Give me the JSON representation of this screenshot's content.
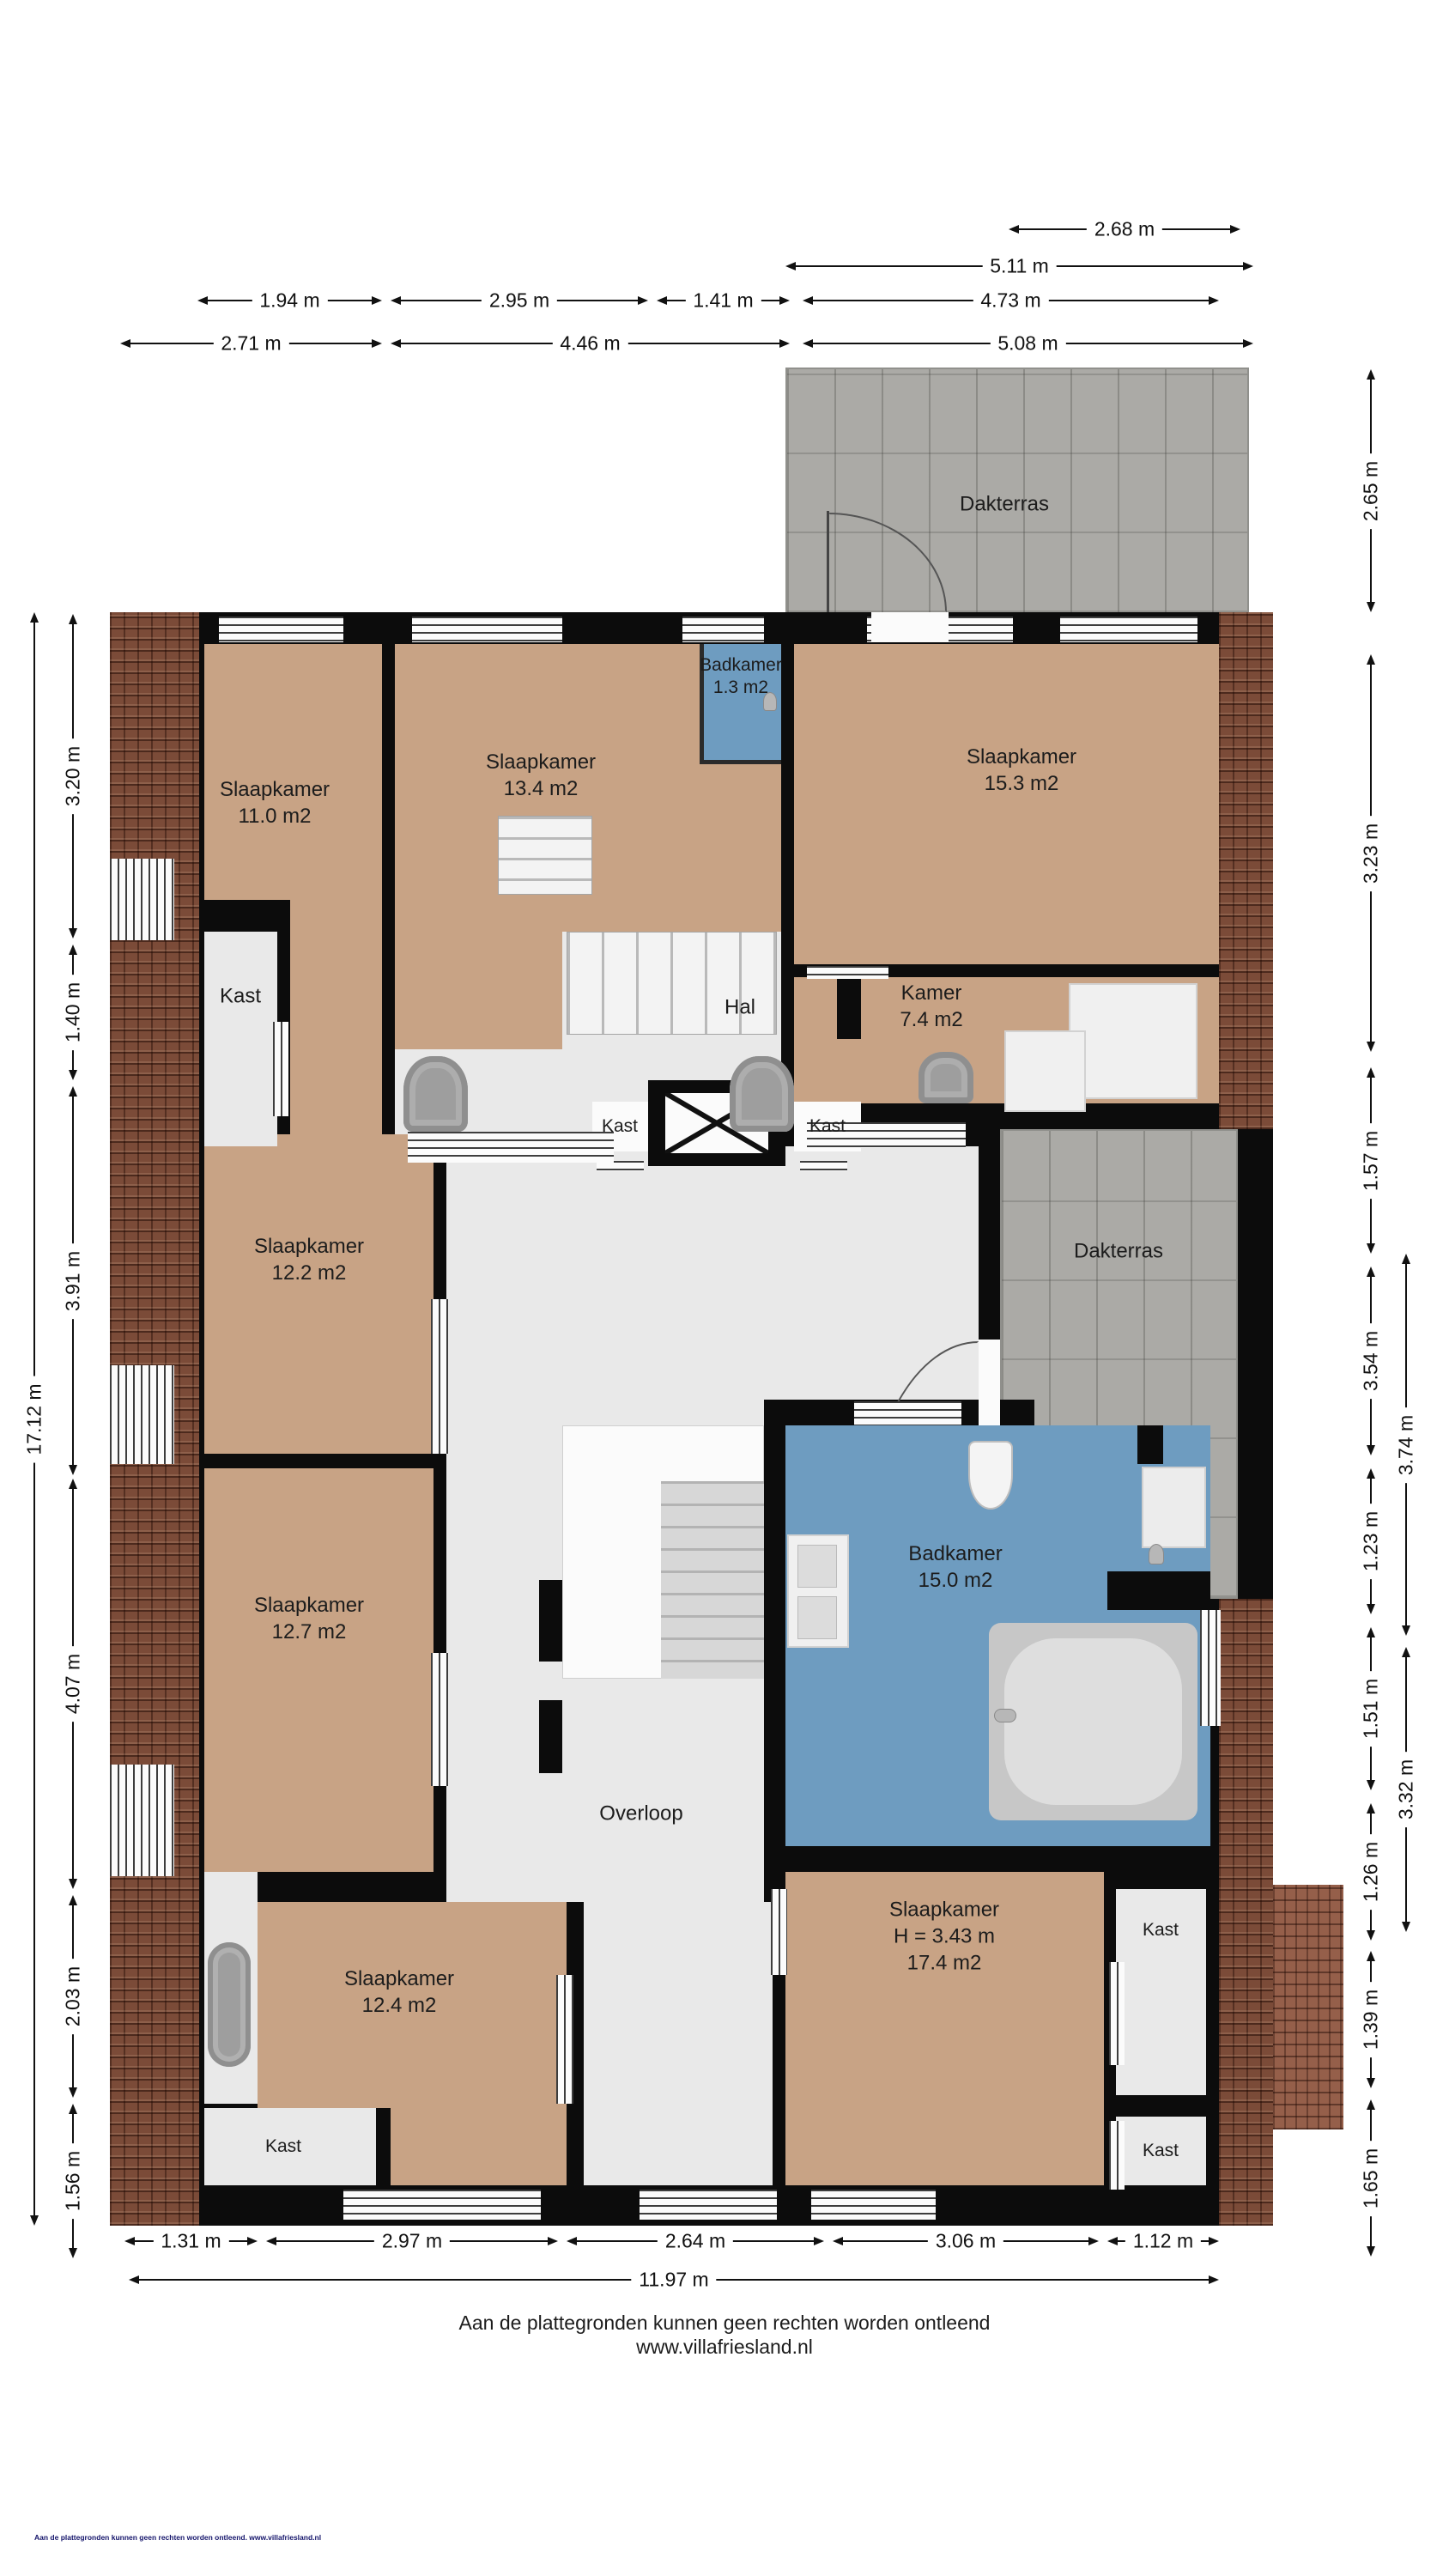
{
  "title": "Plattegrond verdieping",
  "colors": {
    "wall": "#0c0c0c",
    "bedroom_floor": "#c8a385",
    "hall_floor": "#e9e9e9",
    "bathroom_floor": "#6e9cc0",
    "terrace_tiles": "#abaaa6",
    "brick_edge": "#7b4b38",
    "dimension_line": "#111111"
  },
  "rooms": {
    "dakterras_boven": "Dakterras",
    "dakterras_midden": "Dakterras",
    "slaapkamer_linksboven": {
      "name": "Slaapkamer",
      "area": "11.0 m2"
    },
    "slaapkamer_middenboven": {
      "name": "Slaapkamer",
      "area": "13.4 m2"
    },
    "badkamer_klein": {
      "name": "Badkamer",
      "area": "1.3 m2"
    },
    "slaapkamer_rechtsboven": {
      "name": "Slaapkamer",
      "area": "15.3 m2"
    },
    "kast_linksboven": "Kast",
    "hal": "Hal",
    "kamer": {
      "name": "Kamer",
      "area": "7.4 m2"
    },
    "kast_midden_links": "Kast",
    "kast_midden_rechts": "Kast",
    "slaapkamer_links_midden": {
      "name": "Slaapkamer",
      "area": "12.2 m2"
    },
    "slaapkamer_links_onder": {
      "name": "Slaapkamer",
      "area": "12.7 m2"
    },
    "badkamer_groot": {
      "name": "Badkamer",
      "area": "15.0 m2"
    },
    "overloop": "Overloop",
    "slaapkamer_onder_links": {
      "name": "Slaapkamer",
      "area": "12.4 m2"
    },
    "slaapkamer_onder_rechts": {
      "name": "Slaapkamer",
      "height": "H = 3.43 m",
      "area": "17.4 m2"
    },
    "kast_rechts_boven": "Kast",
    "kast_rechts_onder": "Kast",
    "kast_links_onder": "Kast"
  },
  "dimensions": {
    "top": [
      "2.68 m",
      "5.11 m",
      "1.94 m",
      "2.95 m",
      "1.41 m",
      "4.73 m",
      "2.71 m",
      "4.46 m",
      "5.08 m"
    ],
    "bottom": [
      "1.31 m",
      "2.97 m",
      "2.64 m",
      "3.06 m",
      "1.12 m",
      "11.97 m"
    ],
    "left": [
      "3.20 m",
      "1.40 m",
      "3.91 m",
      "4.07 m",
      "2.03 m",
      "1.56 m",
      "17.12 m"
    ],
    "right": [
      "2.65 m",
      "3.23 m",
      "1.57 m",
      "3.54 m",
      "3.74 m",
      "1.23 m",
      "3.32 m",
      "1.51 m",
      "1.26 m",
      "1.39 m",
      "1.65 m"
    ]
  },
  "footer": {
    "line1": "Aan de plattegronden kunnen geen rechten worden ontleend",
    "line2": "www.villafriesland.nl",
    "tiny": "Aan de plattegronden kunnen geen rechten worden ontleend. www.villafriesland.nl"
  }
}
